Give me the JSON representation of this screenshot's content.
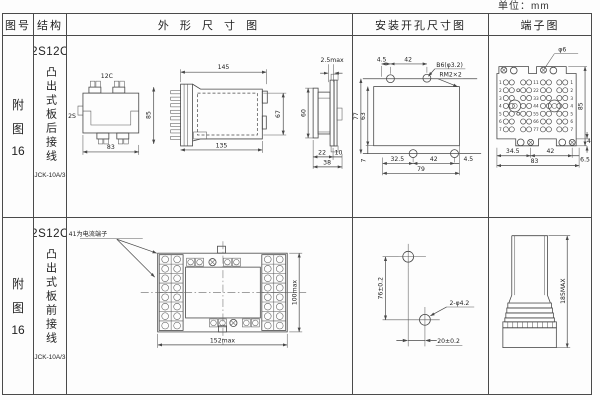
{
  "unit_label": "单位：mm",
  "headers": {
    "fig_no": "图号",
    "structure": "结构",
    "outline": "外 形 尺 寸 图",
    "install": "安装开孔尺寸图",
    "terminal": "端子图"
  },
  "row1": {
    "fig": {
      "c1": "附",
      "c2": "图",
      "c3": "16"
    },
    "structure": {
      "model": "2S12C",
      "wiring": "凸出式板后接线",
      "product": "JCK-10A/3"
    },
    "top_view": {
      "label_top": "12C",
      "label_left": "2S",
      "width": "83",
      "height": "85"
    },
    "side_view": {
      "top_width": "145",
      "bottom_width": "135",
      "height_right": "67"
    },
    "rear_view": {
      "gap": "2.5max",
      "height": "60",
      "b1": "22",
      "b2": "10",
      "b_total": "38"
    },
    "install": {
      "t1": "4.5",
      "t2": "42",
      "hole_callout": "B6(φ3.2)",
      "thread_callout": "RM2×2",
      "left_outer": "77",
      "left_inner": "63",
      "left_bottom": "7",
      "b1": "32.5",
      "b2": "42",
      "b3": "4.5",
      "b_total": "79"
    },
    "terminal": {
      "screw_callout": "φ6",
      "rows": [
        1,
        2,
        3,
        4,
        5,
        6,
        7
      ],
      "b1": "34.5",
      "b2": "42",
      "b3": "6.5",
      "b_total": "83",
      "height": "85",
      "offset": "4"
    }
  },
  "row2": {
    "fig": {
      "c1": "附",
      "c2": "图",
      "c3": "16"
    },
    "structure": {
      "model": "2S12C",
      "wiring": "凸出式板前接线",
      "product": "JCK-10A/3"
    },
    "front_view": {
      "note": "31、41为电流端子",
      "width": "152max",
      "height": "100max"
    },
    "install": {
      "v": "76±0.2",
      "h": "20±0.2",
      "hole_callout": "2-φ4.2"
    },
    "side_view": {
      "height": "185MAX"
    }
  }
}
